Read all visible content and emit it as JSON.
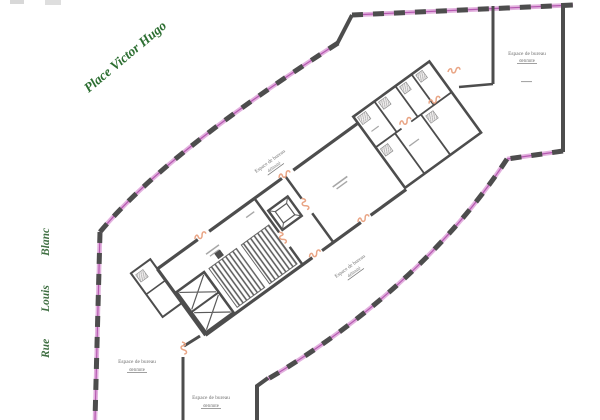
{
  "streets": {
    "top_label": "Place Victor Hugo",
    "left_words": [
      "Rue",
      "Louis",
      "Blanc"
    ]
  },
  "office_label": {
    "line1": "Espace de bureau",
    "line2": "délimité"
  },
  "colors": {
    "street_green": "#2c6e31",
    "wall_gray": "#4d4d4d",
    "hatch_magenta": "#b558b0",
    "hatch_pink": "#e2b1de",
    "opening_salmon": "#e9a585",
    "label_gray": "#5f5f5f",
    "background": "#ffffff"
  }
}
